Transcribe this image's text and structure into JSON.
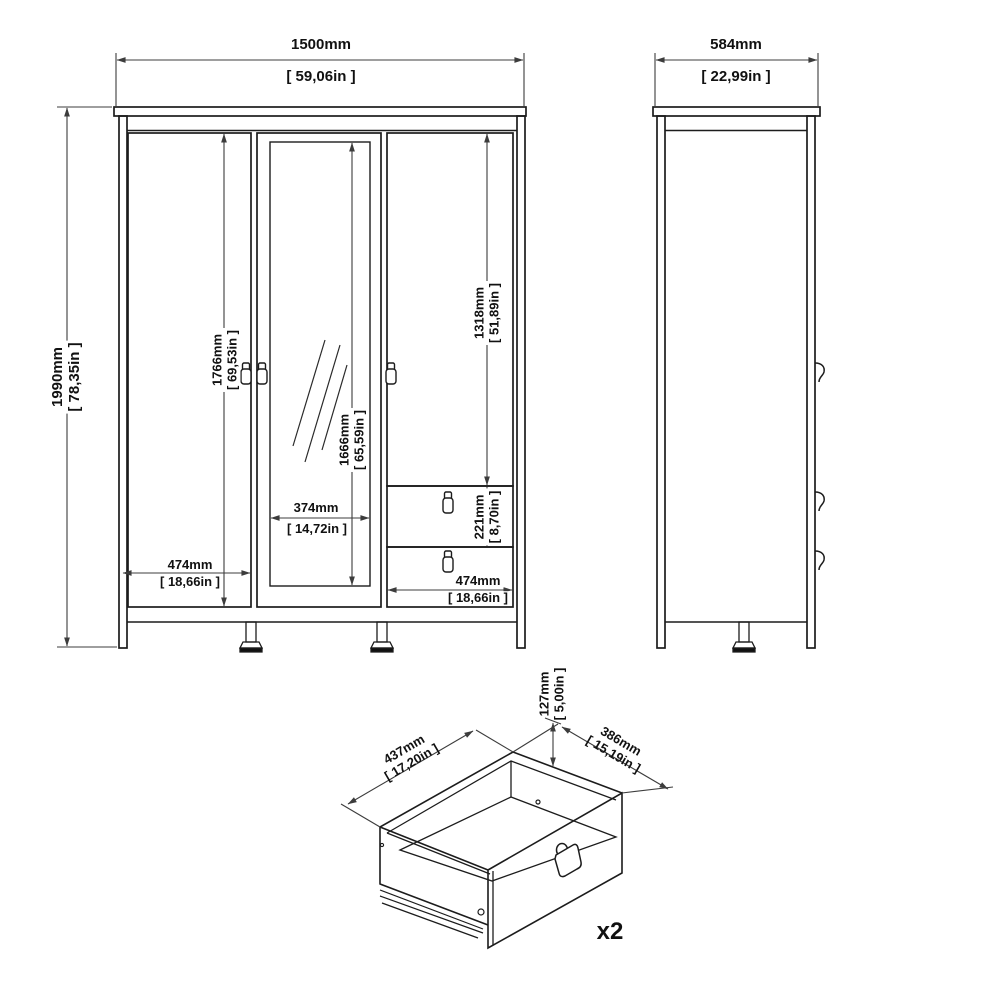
{
  "front_view": {
    "overall_width": {
      "mm": "1500mm",
      "in": "[ 59,06in ]"
    },
    "overall_height": {
      "mm": "1990mm",
      "in": "[ 78,35in ]"
    },
    "left_door_height": {
      "mm": "1766mm",
      "in": "[ 69,53in ]"
    },
    "mirror_height": {
      "mm": "1666mm",
      "in": "[ 65,59in ]"
    },
    "right_door_height": {
      "mm": "1318mm",
      "in": "[ 51,89in ]"
    },
    "mirror_width": {
      "mm": "374mm",
      "in": "[ 14,72in ]"
    },
    "left_door_width": {
      "mm": "474mm",
      "in": "[ 18,66in ]"
    },
    "drawer_front_height": {
      "mm": "221mm",
      "in": "[ 8,70in ]"
    },
    "right_section_width": {
      "mm": "474mm",
      "in": "[ 18,66in ]"
    }
  },
  "side_view": {
    "overall_depth": {
      "mm": "584mm",
      "in": "[ 22,99in ]"
    }
  },
  "drawer_detail": {
    "inner_width": {
      "mm": "437mm",
      "in": "[ 17,20in ]"
    },
    "inner_depth": {
      "mm": "386mm",
      "in": "[ 15,19in ]"
    },
    "side_height": {
      "mm": "127mm",
      "in": "[ 5,00in ]"
    },
    "quantity_label": "x2"
  },
  "colors": {
    "line": "#1c1c1c",
    "dimension_line": "#3c3c3c",
    "background": "#ffffff",
    "text": "#111111"
  }
}
